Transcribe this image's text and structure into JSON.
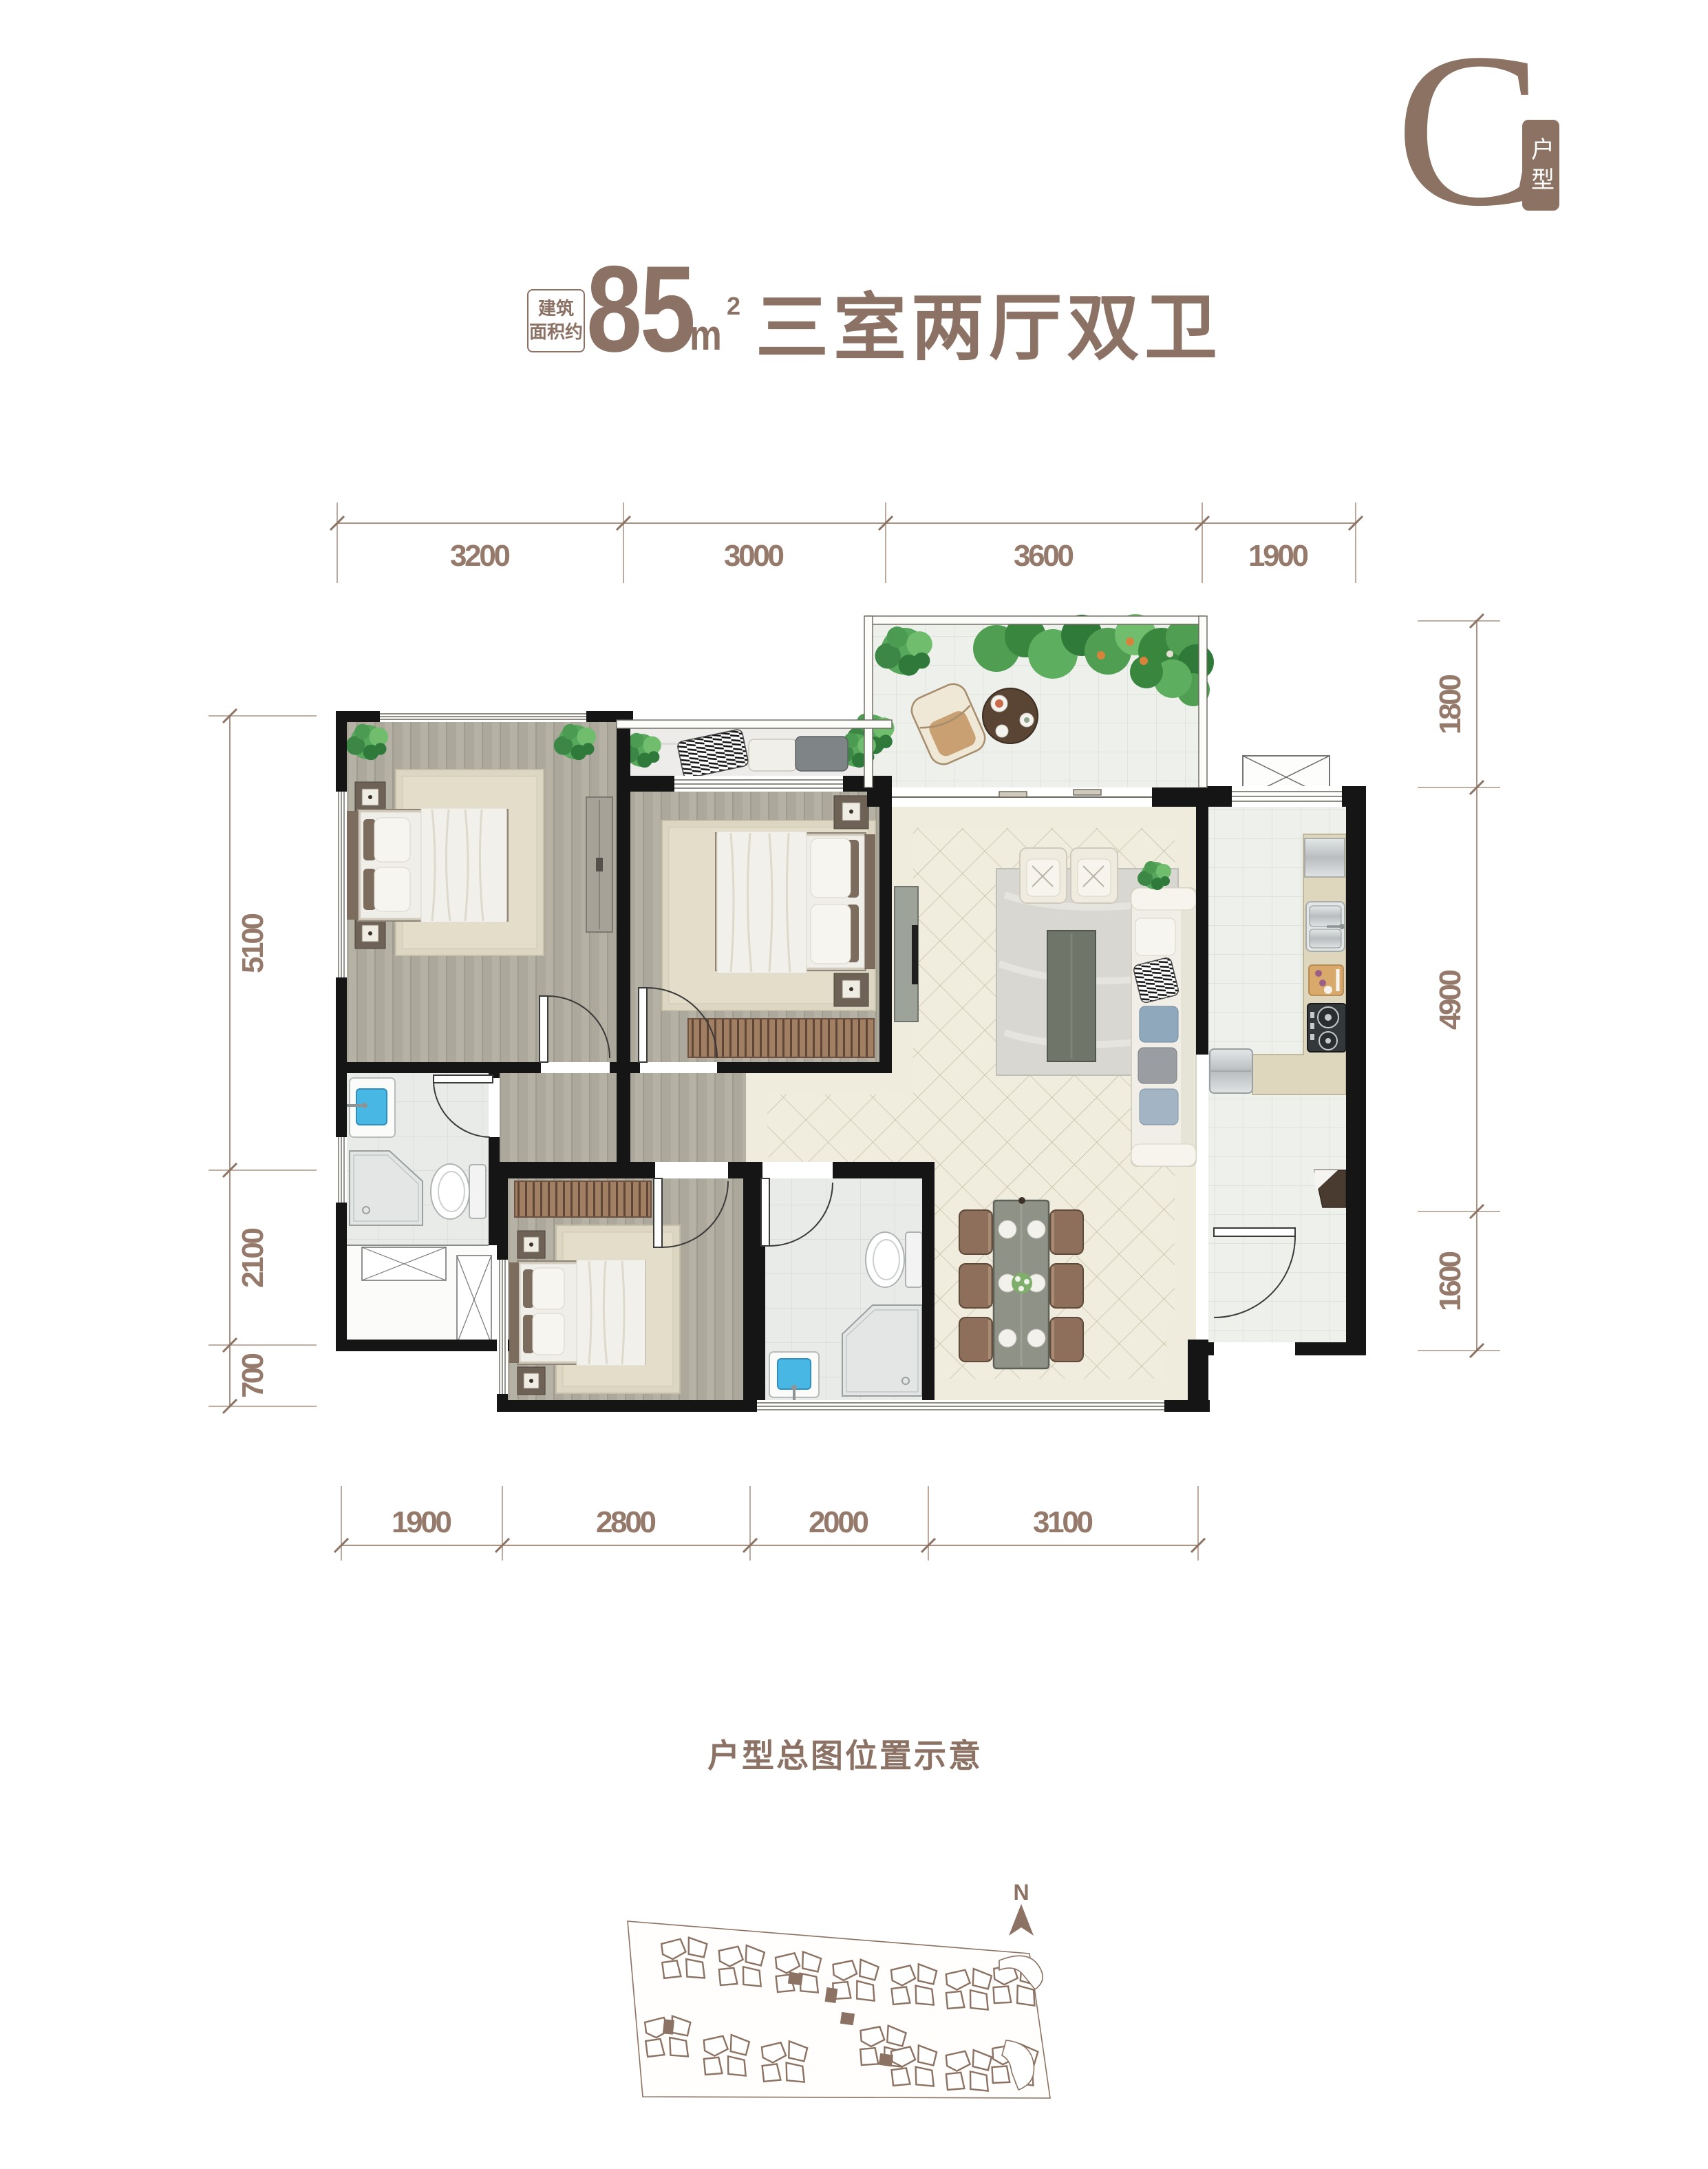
{
  "unit_badge": {
    "letter": "C",
    "vertical_label": "户型"
  },
  "title": {
    "area_label_line1": "建筑",
    "area_label_line2": "面积约",
    "area_value": "85",
    "area_unit": "m",
    "area_unit_exponent": "2",
    "layout_name": "三室两厅双卫"
  },
  "dimensions": {
    "top": [
      "3200",
      "3000",
      "3600",
      "1900"
    ],
    "bottom": [
      "1900",
      "2800",
      "2000",
      "3100"
    ],
    "left": [
      "5100",
      "2100",
      "700"
    ],
    "right": [
      "1800",
      "4900",
      "1600"
    ]
  },
  "site_plan": {
    "caption": "户型总图位置示意",
    "north_label": "N"
  },
  "colors": {
    "accent": "#8b7262",
    "dim_text": "#95796a",
    "wall": "#151515",
    "highlight": "#8b7262"
  }
}
